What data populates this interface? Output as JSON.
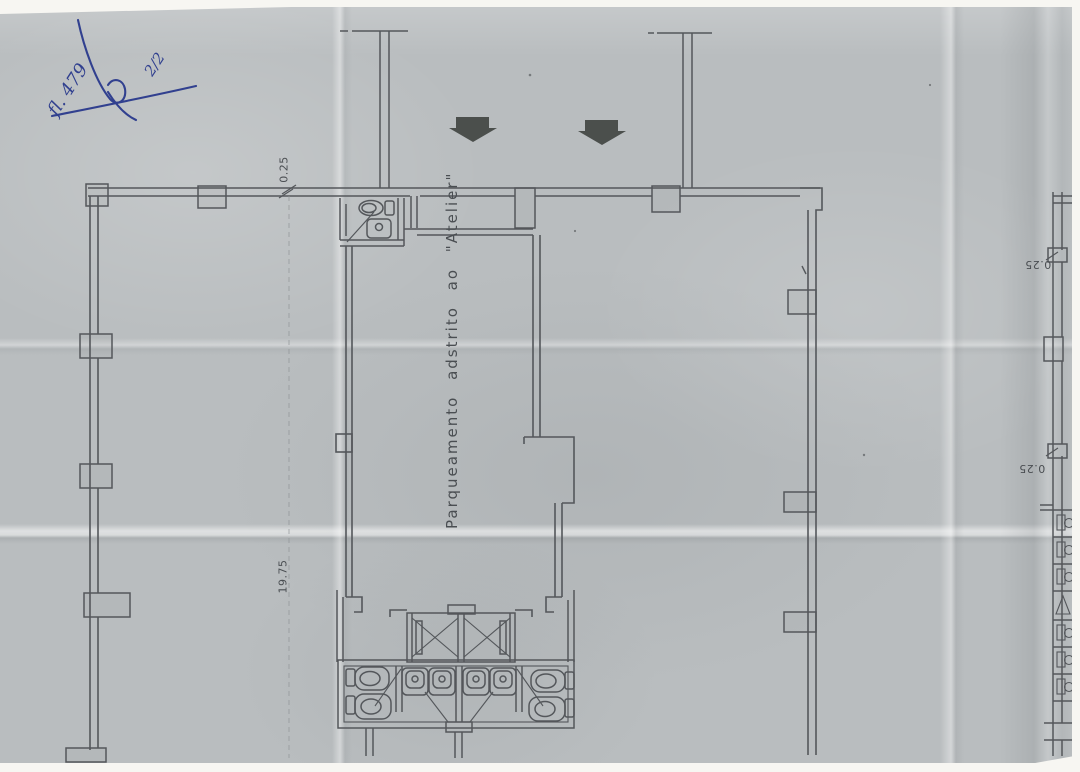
{
  "paper": {
    "color": "#b9bdbf",
    "line_color": "#54575b",
    "faint_line_color": "#8f9396",
    "margin_color": "#f7f6f2"
  },
  "handwriting": {
    "sheet_number": "fl. 479",
    "page_fraction": "2/2",
    "ink_color": "#31408f"
  },
  "plan": {
    "area_label": "Parqueamento adstrito ao \"Atelier\"",
    "dimensions": {
      "top_wall_offset": "0.25",
      "left_side_length": "19.75"
    },
    "adjacent_plan_dimensions": {
      "upper": "0.25",
      "lower": "0.25"
    },
    "entrance_arrows": {
      "count": "2",
      "color": "#4b4f4c"
    }
  }
}
